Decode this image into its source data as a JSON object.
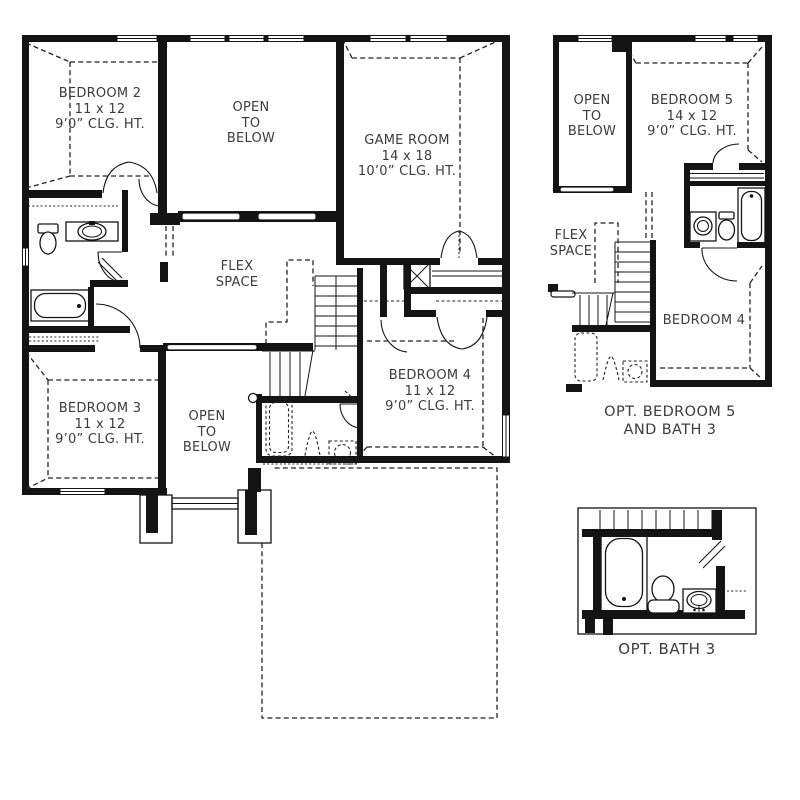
{
  "page": {
    "background": "#ffffff"
  },
  "colors": {
    "wall_line": "#141414",
    "label_text": "#3c3c3c"
  },
  "main_plan": {
    "bedroom2": {
      "name": "BEDROOM 2",
      "dims": "11 x 12",
      "ceiling": "9’0” CLG. HT."
    },
    "open_to_below_upper": {
      "line1": "OPEN",
      "line2": "TO",
      "line3": "BELOW"
    },
    "game_room": {
      "name": "GAME ROOM",
      "dims": "14 x 18",
      "ceiling": "10’0” CLG. HT."
    },
    "flex_space": {
      "line1": "FLEX",
      "line2": "SPACE"
    },
    "bedroom3": {
      "name": "BEDROOM 3",
      "dims": "11 x 12",
      "ceiling": "9’0” CLG. HT."
    },
    "open_to_below_lower": {
      "line1": "OPEN",
      "line2": "TO",
      "line3": "BELOW"
    },
    "bedroom4": {
      "name": "BEDROOM 4",
      "dims": "11 x 12",
      "ceiling": "9’0” CLG. HT."
    }
  },
  "opt_bedroom5_inset": {
    "open_to_below": {
      "line1": "OPEN",
      "line2": "TO",
      "line3": "BELOW"
    },
    "bedroom5": {
      "name": "BEDROOM 5",
      "dims": "14 x 12",
      "ceiling": "9’0” CLG. HT."
    },
    "flex_space": {
      "line1": "FLEX",
      "line2": "SPACE"
    },
    "bedroom4": {
      "name": "BEDROOM 4"
    },
    "caption_line1": "OPT. BEDROOM 5",
    "caption_line2": "AND BATH 3"
  },
  "opt_bath3_inset": {
    "caption": "OPT. BATH 3"
  }
}
